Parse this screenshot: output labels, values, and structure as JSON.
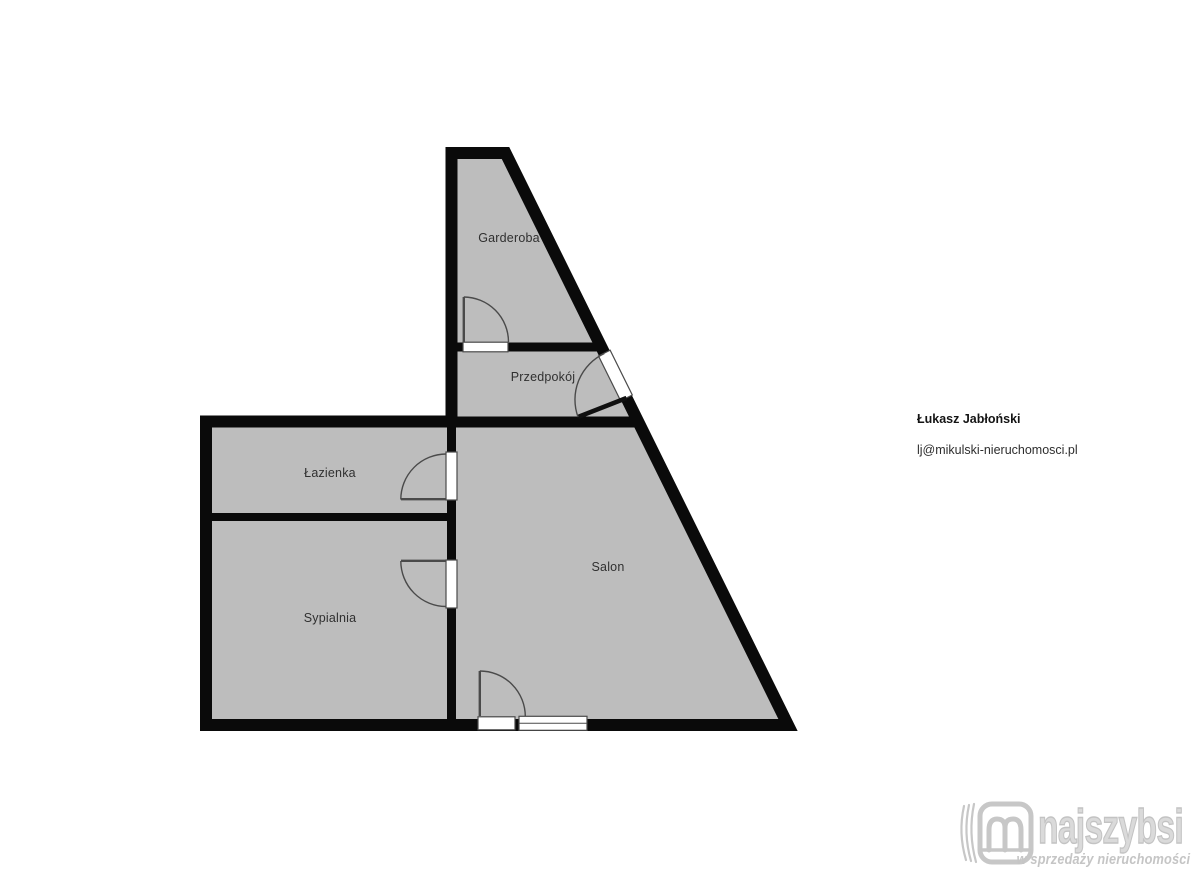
{
  "colors": {
    "wall": "#0a0a0a",
    "room_fill": "#bdbdbd",
    "door_line": "#4a4a4a",
    "label_text": "#303030",
    "logo_gray": "#c6c6c6"
  },
  "floorplan": {
    "rooms": [
      {
        "id": "garderoba",
        "label": "Garderoba"
      },
      {
        "id": "przedpokoj",
        "label": "Przedpokój"
      },
      {
        "id": "lazienka",
        "label": "Łazienka"
      },
      {
        "id": "sypialnia",
        "label": "Sypialnia"
      },
      {
        "id": "salon",
        "label": "Salon"
      }
    ]
  },
  "agent": {
    "name": "Łukasz Jabłoński",
    "email": "lj@mikulski-nieruchomosci.pl"
  },
  "logo": {
    "brand": "najszybsi",
    "tagline": "w sprzedaży nieruchomości"
  }
}
